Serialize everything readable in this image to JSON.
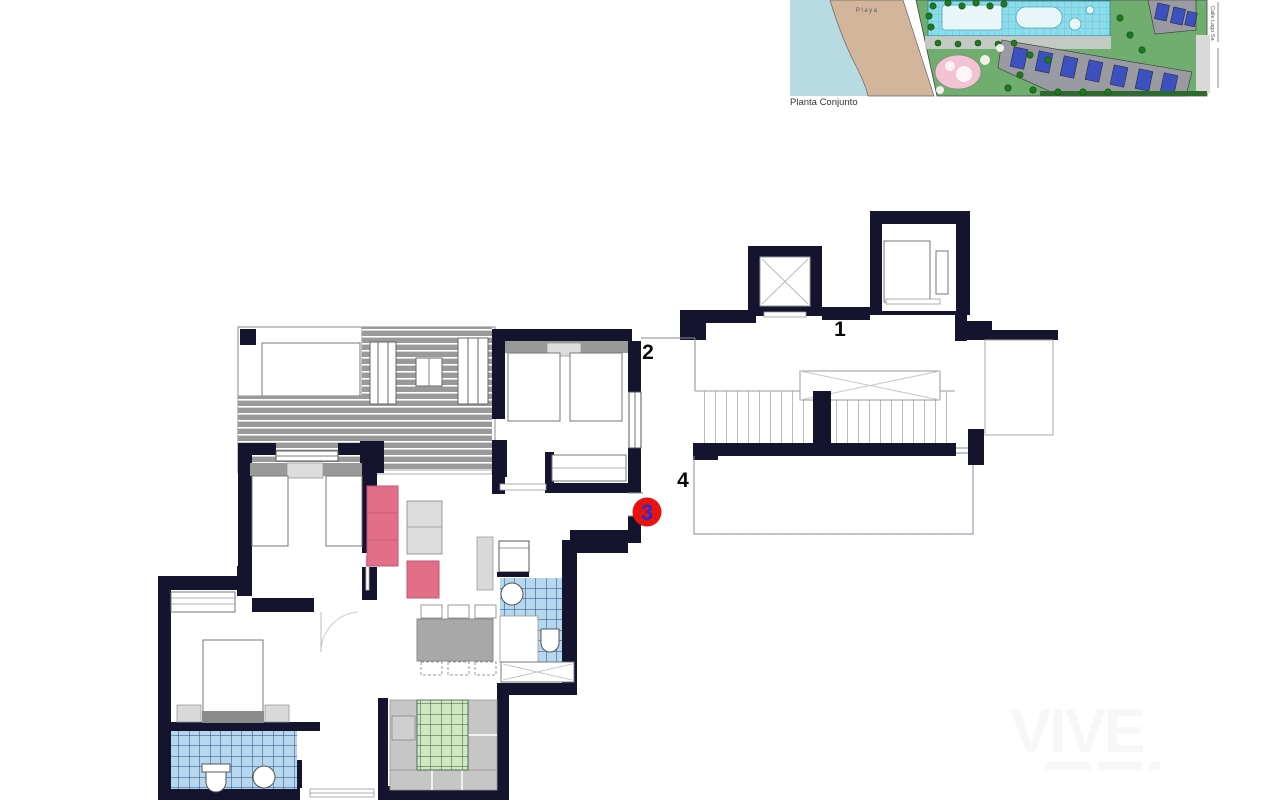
{
  "site_plan": {
    "caption": "Planta Conjunto",
    "beach_label": "Playa",
    "street_label": "Calle Lago Sa",
    "colors": {
      "sea": "#b7dae3",
      "beach": "#d2b59b",
      "grounds_green": "#6fae6e",
      "pool": "#8edbe9",
      "spa_pink": "#f2c4d2",
      "building_gray": "#9a9aa2",
      "building_roof_blue": "#3c50c0",
      "tree_green": "#1e7a1e"
    }
  },
  "floor_plan": {
    "unit_labels": [
      {
        "text": "1"
      },
      {
        "text": "2"
      },
      {
        "text": "4"
      }
    ],
    "selected_unit": {
      "number": "3",
      "badge_background": "#e8120e",
      "badge_number_color": "#2b2bd0"
    },
    "colors": {
      "wall": "#14142f",
      "deck_gray": "#9a9a9a",
      "bathroom_tile_blue": "#b5d8ee",
      "kitchen_tile_green": "#cfe8c2",
      "sofa_pink": "#e26e87",
      "counter_gray": "#c6c6c6"
    }
  },
  "watermark": {
    "text": "VIVE"
  }
}
